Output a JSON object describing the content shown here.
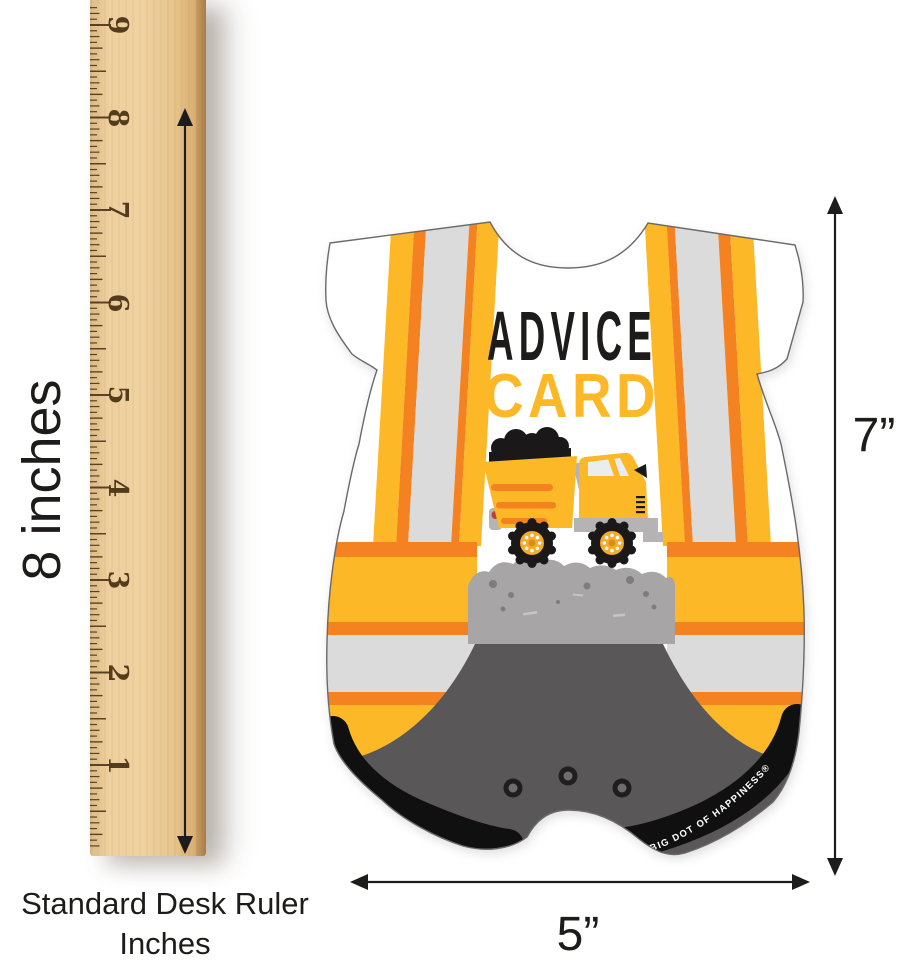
{
  "page": {
    "background": "#ffffff"
  },
  "ruler": {
    "numbers": [
      "9",
      "8",
      "7",
      "6",
      "5",
      "4",
      "3",
      "2",
      "1"
    ],
    "side_label": "8 inches",
    "caption_line1": "Standard Desk Ruler",
    "caption_line2": "Inches"
  },
  "dimensions": {
    "card_height": "7”",
    "card_width": "5”"
  },
  "card": {
    "title_line1": "ADVICE",
    "title_line2": "CARD",
    "brand_text": "®BIG DOT OF HAPPINESS®"
  },
  "colors": {
    "vest_yellow": "#fcb826",
    "safety_orange": "#f58220",
    "vest_gray": "#dcdbdb",
    "pants_gray": "#595757",
    "dirt_gray": "#a7a5a5",
    "ink_black": "#1d1c1a",
    "wood_tan": "#e9c897",
    "hub_orange": "#f7a929"
  }
}
